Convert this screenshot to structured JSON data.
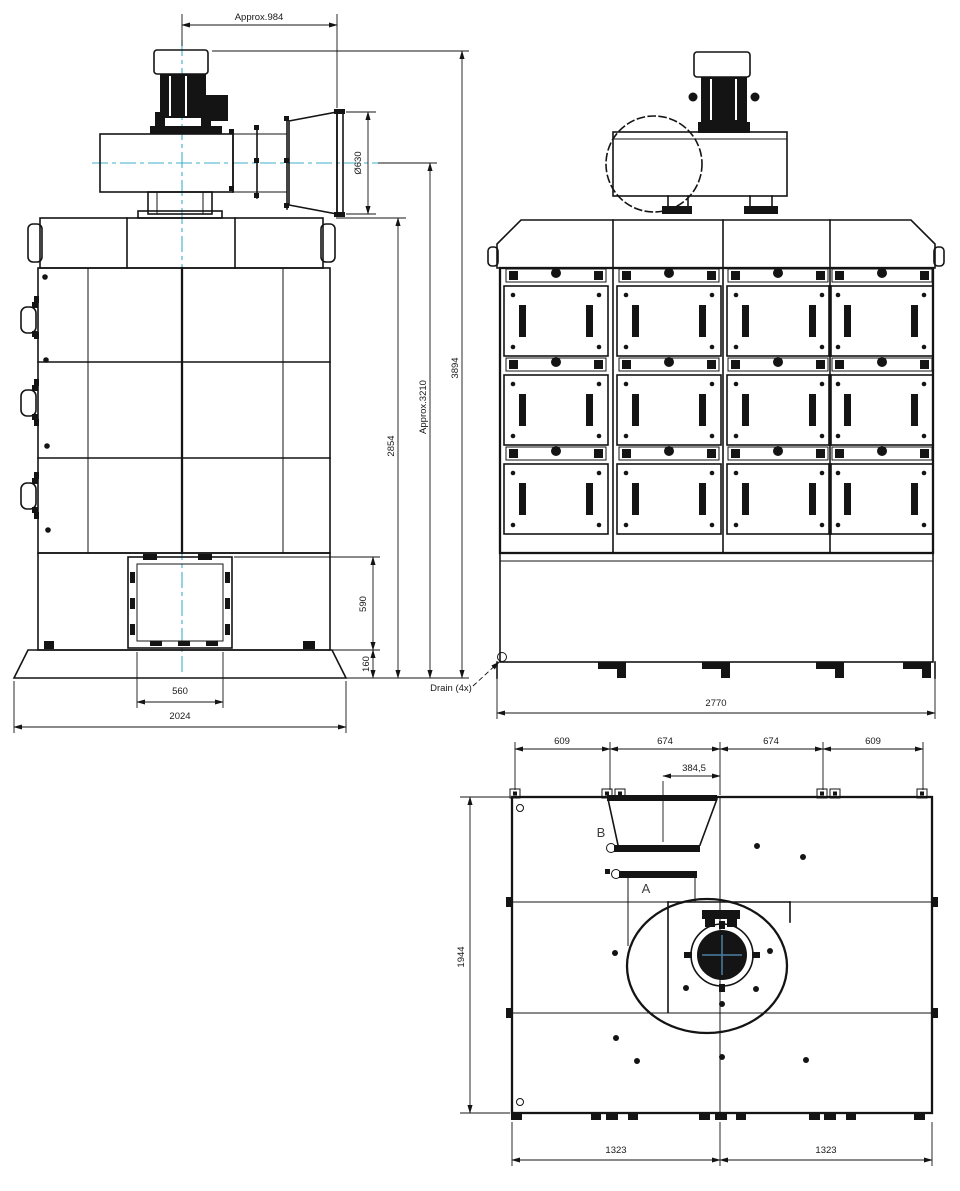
{
  "drawing_type": "technical-orthographic-views",
  "colors": {
    "line": "#141414",
    "centerline": "#3fb0c9",
    "crosshair": "#4a7fa5",
    "background": "#ffffff"
  },
  "views": {
    "side": {
      "dims": {
        "approx_width": "Approx.984",
        "outlet_diameter": "Ø630",
        "body_height": "2854",
        "approx_height": "Approx.3210",
        "total_height": "3894",
        "bin_height": "590",
        "base_height": "160",
        "bin_width": "560",
        "base_width": "2024"
      }
    },
    "front": {
      "drain_label": "Drain (4x)",
      "dims": {
        "overall_width": "2770"
      }
    },
    "top": {
      "labels": {
        "outlet_b": "B",
        "outlet_a": "A"
      },
      "dims": {
        "span_left_outer": "609",
        "span_left_inner": "674",
        "span_right_inner": "674",
        "span_right_outer": "609",
        "outlet_offset": "384,5",
        "depth": "1944",
        "foot_left": "1323",
        "foot_right": "1323"
      }
    }
  }
}
